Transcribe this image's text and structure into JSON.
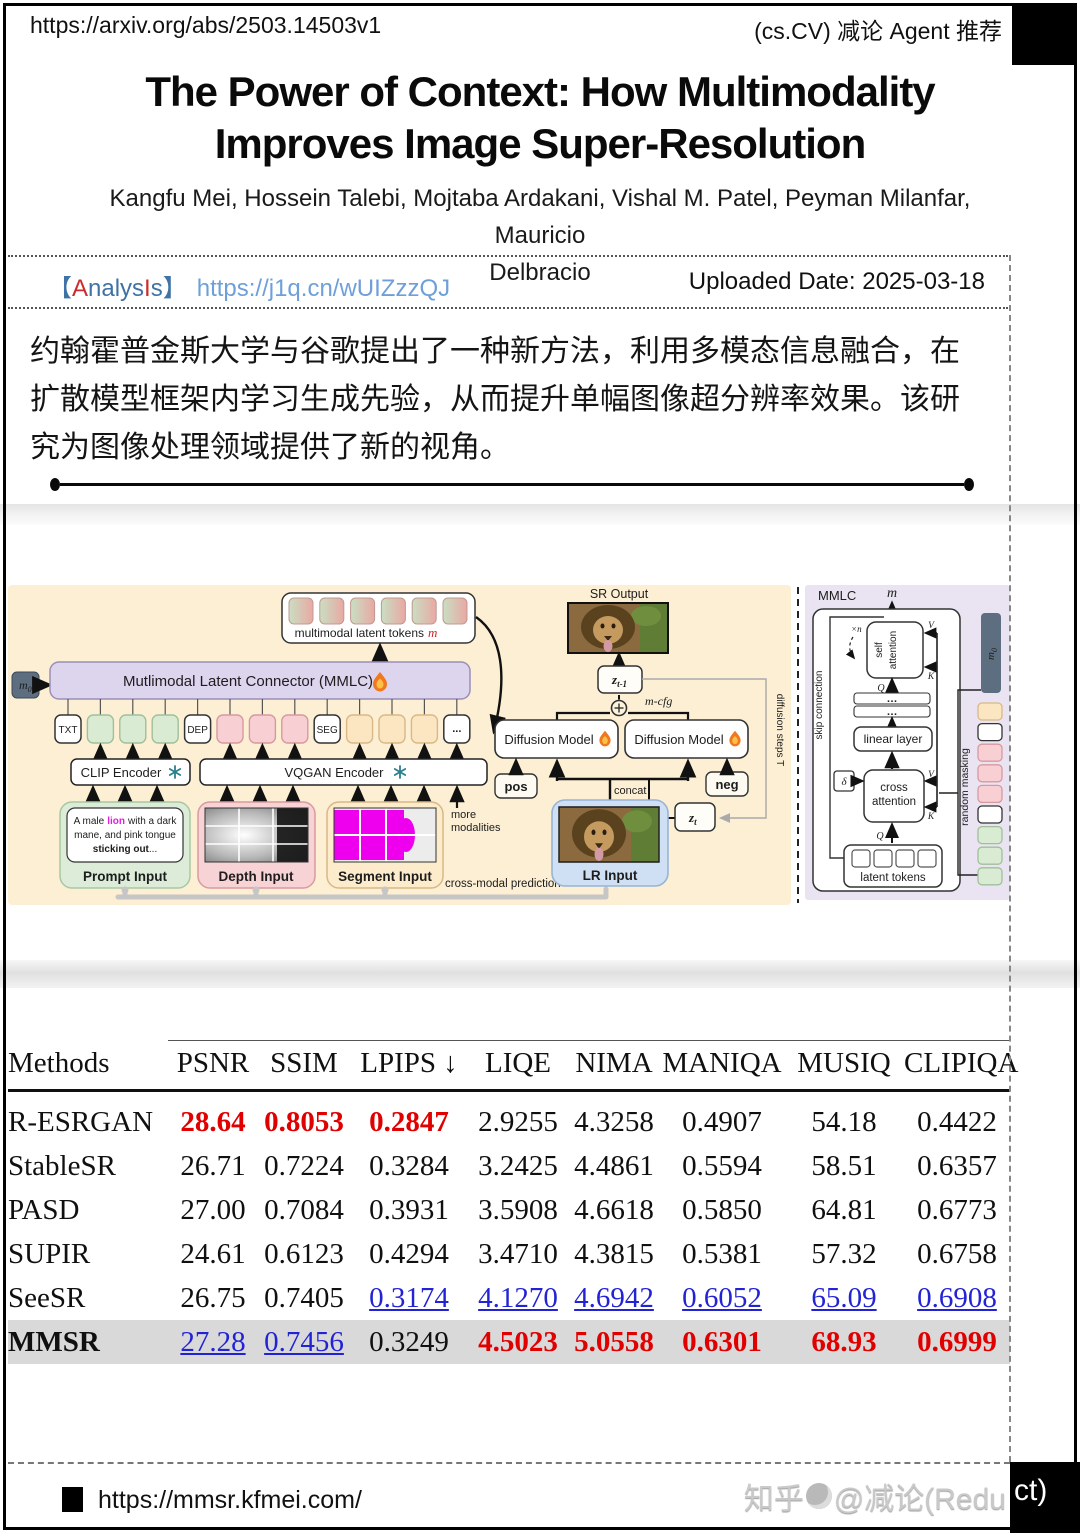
{
  "page": {
    "top_bar": {
      "url": "https://arxiv.org/abs/2503.14503v1",
      "right_label": "(cs.CV) 减论 Agent 推荐"
    },
    "title_lines": [
      "The Power of Context: How Multimodality",
      "Improves Image Super-Resolution"
    ],
    "author_lines": [
      "Kangfu Mei, Hossein Talebi, Mojtaba Ardakani, Vishal M. Patel, Peyman Milanfar, Mauricio",
      "Delbracio"
    ],
    "meta": {
      "analysis_open": "【",
      "analysis_a": "A",
      "analysis_mid": "nalys",
      "analysis_i": "I",
      "analysis_s": "s",
      "analysis_close": "】",
      "analysis_url": "https://j1q.cn/wUIZzzQJ",
      "uploaded": "Uploaded Date: 2025-03-18"
    },
    "summary": "约翰霍普金斯大学与谷歌提出了一种新方法，利用多模态信息融合，在扩散模型框架内学习生成先验，从而提升单幅图像超分辨率效果。该研究为图像处理领域提供了新的视角。",
    "footer": {
      "project_url": "https://mmsr.kfmei.com/",
      "watermark_prefix": "知乎",
      "watermark_main": "@减论(Redu",
      "watermark_on_black": "ct)"
    }
  },
  "figure": {
    "left": {
      "m0": "m",
      "m0_sub": "0",
      "mmlc_bar": "Mutlimodal Latent Connector (MMLC)",
      "tokens_caption": "multimodal latent tokens",
      "tokens_caption_m": "m",
      "txt": "TXT",
      "dep": "DEP",
      "seg": "SEG",
      "dots": "...",
      "clip_encoder": "CLIP Encoder",
      "vqgan_encoder": "VQGAN Encoder",
      "prompt_l1a": "A male",
      "prompt_lion": "lion",
      "prompt_l1c": "with a dark",
      "prompt_l2": "mane, and pink tongue",
      "prompt_l3a": "sticking out",
      "prompt_l3b": "...",
      "prompt_caption": "Prompt Input",
      "depth_caption": "Depth Input",
      "segment_caption": "Segment Input",
      "more_1": "more",
      "more_2": "modalities",
      "cross_modal": "cross-modal prediction"
    },
    "mid": {
      "sr_output": "SR Output",
      "z": "z",
      "z_prev_sub": "t-1",
      "z_t_sub": "t",
      "m_cfg": "m-cfg",
      "diffusion_model": "Diffusion Model",
      "pos": "pos",
      "neg": "neg",
      "concat": "concat",
      "lr_caption": "LR Input",
      "diffusion_steps": "diffusion steps T"
    },
    "right": {
      "title": "MMLC",
      "m": "m",
      "skip": "skip connection",
      "self_1": "self",
      "self_2": "attention",
      "xn": "×n",
      "q": "Q",
      "k": "K",
      "v": "V",
      "dots": "…",
      "linear": "linear layer",
      "delta": "δ",
      "cross_1": "cross",
      "cross_2": "attention",
      "latent_caption": "latent tokens",
      "masking": "random masking",
      "m0": "m",
      "m0_sub": "0"
    }
  },
  "colors": {
    "analysis_red": "#cf2b2b",
    "analysis_blue": "#3f72a5",
    "link_blue": "#6f9fd9",
    "best_red": "#e00000",
    "second_blue": "#2323d6",
    "highlight_row": "#d9d9d9",
    "figure_cream": "#fcefd4",
    "figure_lavender": "#eae4f2",
    "mmlc_purple": "#ddd4ee",
    "slate_token": "#5d6e80"
  },
  "chart_data": {
    "type": "table",
    "title": "Benchmark comparison of super-resolution methods",
    "columns": [
      "Methods",
      "PSNR",
      "SSIM",
      "LPIPS ↓",
      "LIQE",
      "NIMA",
      "MANIQA",
      "MUSIQ",
      "CLIPIQA"
    ],
    "style_legend": {
      "best": "red bold = best",
      "second": "blue underline = second best",
      "plain": "default"
    },
    "rows": [
      {
        "method": "R-ESRGAN",
        "values": [
          "28.64",
          "0.8053",
          "0.2847",
          "2.9255",
          "4.3258",
          "0.4907",
          "54.18",
          "0.4422"
        ],
        "styles": [
          "best",
          "best",
          "best",
          "plain",
          "plain",
          "plain",
          "plain",
          "plain"
        ],
        "highlight": false
      },
      {
        "method": "StableSR",
        "values": [
          "26.71",
          "0.7224",
          "0.3284",
          "3.2425",
          "4.4861",
          "0.5594",
          "58.51",
          "0.6357"
        ],
        "styles": [
          "plain",
          "plain",
          "plain",
          "plain",
          "plain",
          "plain",
          "plain",
          "plain"
        ],
        "highlight": false
      },
      {
        "method": "PASD",
        "values": [
          "27.00",
          "0.7084",
          "0.3931",
          "3.5908",
          "4.6618",
          "0.5850",
          "64.81",
          "0.6773"
        ],
        "styles": [
          "plain",
          "plain",
          "plain",
          "plain",
          "plain",
          "plain",
          "plain",
          "plain"
        ],
        "highlight": false
      },
      {
        "method": "SUPIR",
        "values": [
          "24.61",
          "0.6123",
          "0.4294",
          "3.4710",
          "4.3815",
          "0.5381",
          "57.32",
          "0.6758"
        ],
        "styles": [
          "plain",
          "plain",
          "plain",
          "plain",
          "plain",
          "plain",
          "plain",
          "plain"
        ],
        "highlight": false
      },
      {
        "method": "SeeSR",
        "values": [
          "26.75",
          "0.7405",
          "0.3174",
          "4.1270",
          "4.6942",
          "0.6052",
          "65.09",
          "0.6908"
        ],
        "styles": [
          "plain",
          "plain",
          "second",
          "second",
          "second",
          "second",
          "second",
          "second"
        ],
        "highlight": false
      },
      {
        "method": "MMSR",
        "values": [
          "27.28",
          "0.7456",
          "0.3249",
          "4.5023",
          "5.0558",
          "0.6301",
          "68.93",
          "0.6999"
        ],
        "styles": [
          "second",
          "second",
          "plain",
          "best",
          "best",
          "best",
          "best",
          "best"
        ],
        "highlight": true
      }
    ]
  }
}
